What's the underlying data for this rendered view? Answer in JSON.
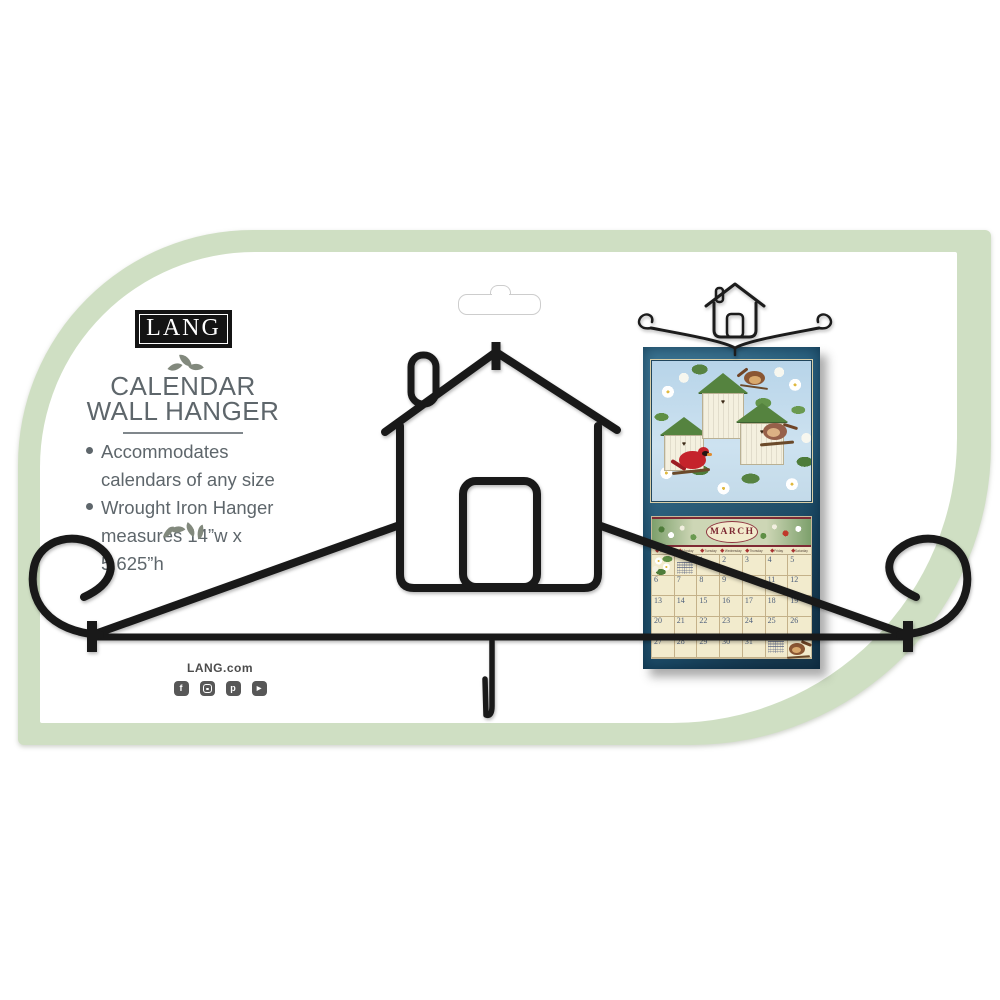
{
  "branding": {
    "logo_text": "LANG",
    "website_label": "LANG.com"
  },
  "packaging": {
    "title_line1": "CALENDAR",
    "title_line2": "WALL HANGER",
    "bullet1": "Accommodates calendars of any size",
    "bullet2": "Wrought Iron Hanger measures 14”w x 5.625”h"
  },
  "social": [
    {
      "name": "facebook",
      "glyph": "f"
    },
    {
      "name": "instagram",
      "glyph": ""
    },
    {
      "name": "pinterest",
      "glyph": "p"
    },
    {
      "name": "youtube",
      "glyph": "▶"
    }
  ],
  "calendar_preview": {
    "month": "MARCH",
    "weekdays": [
      "Sunday",
      "Monday",
      "Tuesday",
      "Wednesday",
      "Thursday",
      "Friday",
      "Saturday"
    ],
    "weeks": [
      [
        "",
        "",
        "1",
        "2",
        "3",
        "4",
        "5"
      ],
      [
        "6",
        "7",
        "8",
        "9",
        "10",
        "11",
        "12"
      ],
      [
        "13",
        "14",
        "15",
        "16",
        "17",
        "18",
        "19"
      ],
      [
        "20",
        "21",
        "22",
        "23",
        "24",
        "25",
        "26"
      ],
      [
        "27",
        "28",
        "29",
        "30",
        "31",
        "",
        ""
      ]
    ]
  },
  "colors": {
    "sage_green": "#cfdfc3",
    "iron_black": "#1a1a1a",
    "calendar_teal": "#265f7e",
    "calendar_cream": "#f2ebcd",
    "banner_red": "#8e3440",
    "text_gray": "#5e666b"
  }
}
